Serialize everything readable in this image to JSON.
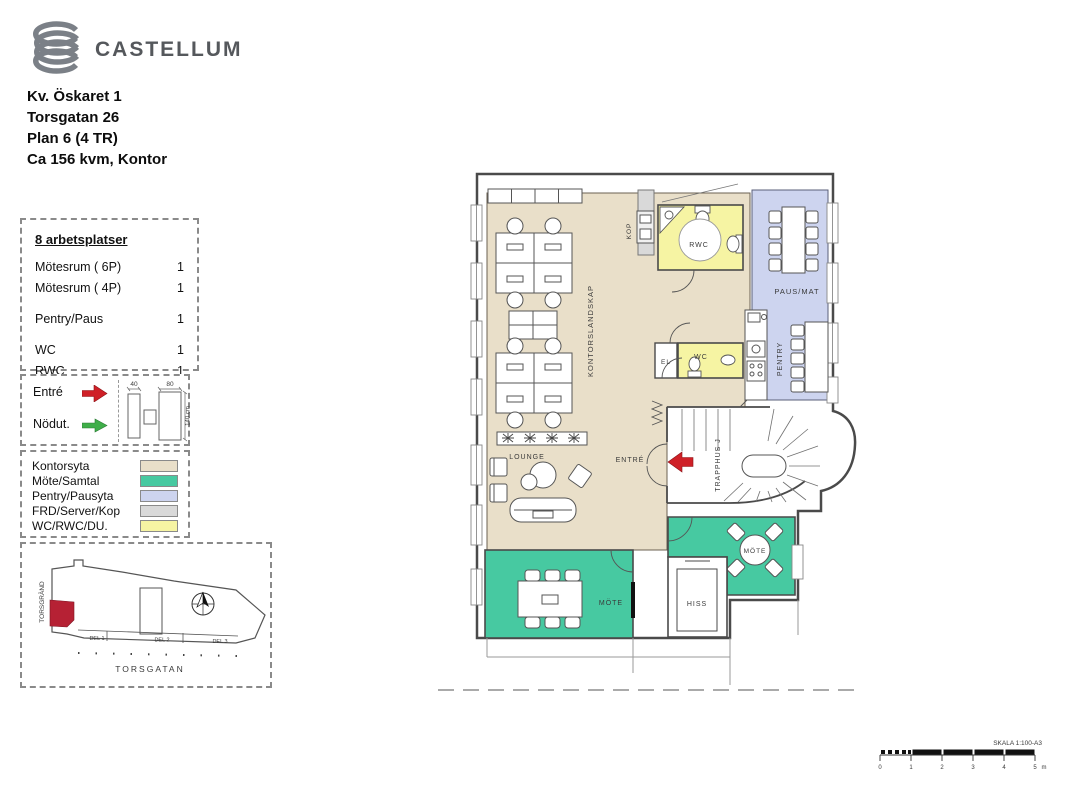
{
  "brand": {
    "name": "CASTELLUM",
    "logo_color": "#7b8087",
    "text_color": "#55585c"
  },
  "header": {
    "line1": "Kv. Öskaret 1",
    "line2": "Torsgatan 26",
    "line3": "Plan 6 (4 TR)",
    "line4": "Ca 156 kvm, Kontor"
  },
  "program": {
    "title": "8 arbetsplatser",
    "rows": [
      {
        "label": "Mötesrum ( 6P)",
        "value": "1"
      },
      {
        "label": "Mötesrum ( 4P)",
        "value": "1"
      },
      {
        "label": "Pentry/Paus",
        "value": "1"
      },
      {
        "label": "WC",
        "value": "1"
      },
      {
        "label": "RWC",
        "value": "1"
      }
    ]
  },
  "symbols": {
    "entre": {
      "label": "Entré",
      "color": "#cf2027"
    },
    "nodut": {
      "label": "Nödut.",
      "color": "#3fae49"
    },
    "dims": {
      "d40": "40",
      "d80": "80",
      "d140": "140 cm"
    }
  },
  "legend": {
    "items": [
      {
        "label": "Kontorsyta",
        "color": "#e9dfc9"
      },
      {
        "label": "Möte/Samtal",
        "color": "#47c9a1"
      },
      {
        "label": "Pentry/Pausyta",
        "color": "#cdd4ef"
      },
      {
        "label": "FRD/Server/Kop",
        "color": "#d9d9d9"
      },
      {
        "label": "WC/RWC/DU.",
        "color": "#f6f4a3"
      }
    ]
  },
  "siteplan": {
    "street_left": "TORSGRÄND",
    "street_bottom": "TORSGATAN",
    "sections": [
      "DEL 1",
      "DEL 2",
      "DEL 3"
    ],
    "highlight_color": "#b62134"
  },
  "plan": {
    "labels": {
      "kontorslandskap": "KONTORSLANDSKAP",
      "kop": "KOP",
      "rwc": "RWC",
      "pausmat": "PAUS/MAT",
      "pentry": "PENTRY",
      "el": "EL",
      "wc": "WC",
      "trapphus": "TRAPPHUS J",
      "entre": "ENTRÉ",
      "lounge": "LOUNGE",
      "mote_6p": "MÖTE",
      "mote_4p": "MÖTE",
      "hiss": "HISS"
    },
    "entry_arrow_color": "#cf2027",
    "wall_color": "#4a4a4a"
  },
  "scalebar": {
    "label": "SKALA 1:100-A3",
    "ticks": [
      "0",
      "1",
      "2",
      "3",
      "4",
      "5"
    ],
    "unit": "m"
  }
}
